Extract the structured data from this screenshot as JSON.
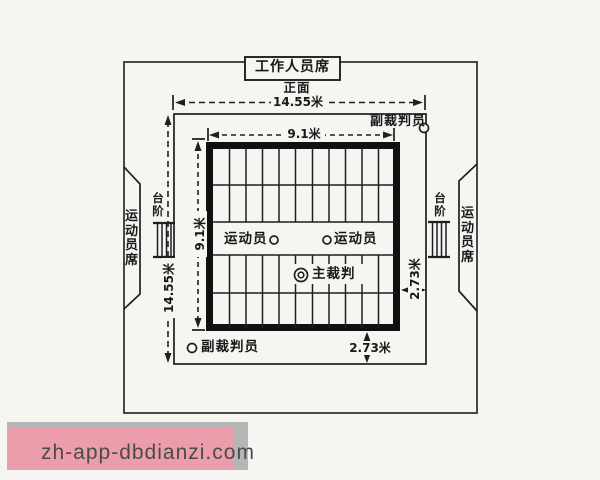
{
  "diagram": {
    "title_box": "工作人员席",
    "front_label": "正面",
    "dim_outer_width": "14.55米",
    "dim_outer_height": "14.55米",
    "dim_inner_width": "9.1米",
    "dim_inner_height": "9.1米",
    "dim_margin_right": "2.73米",
    "dim_margin_bottom": "2.73米",
    "deputy_referee_top": "副裁判员",
    "deputy_referee_bottom": "副裁判员",
    "athlete_left": "运动员",
    "athlete_right": "运动员",
    "chief_referee": "主裁判",
    "steps_left": "台阶",
    "steps_right": "台阶",
    "athlete_seats_left": "运动员席",
    "athlete_seats_right": "运动员席"
  },
  "watermark": {
    "text": "zh-app-dbdianzi.com",
    "pink": "#ec9dab",
    "shadow_gray": "#b6b6b6",
    "text_color": "#4b4b4b"
  },
  "colors": {
    "ink": "#1f1f1f",
    "paper": "#f6f5f2"
  }
}
